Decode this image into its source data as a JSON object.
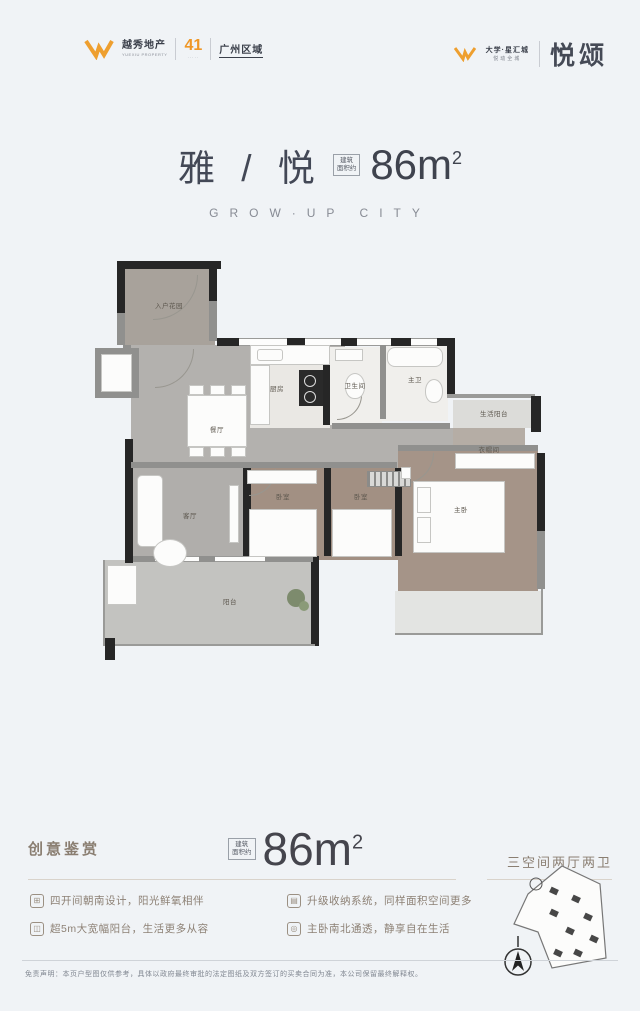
{
  "header": {
    "left_brand": "越秀地产",
    "left_brand_sub": "YUEXIU PROPERTY",
    "left_badge": "41",
    "left_badge_sub": "·····",
    "left_region": "广州区域",
    "right_project": "大学·星汇城",
    "right_project_sub": "悦动全城",
    "right_title": "悦颂"
  },
  "hero": {
    "name": "雅 / 悦",
    "area_prefix_l1": "建筑",
    "area_prefix_l2": "面积约",
    "area_value": "86m",
    "area_sup": "2",
    "subtitle": "GROW·UP CITY"
  },
  "plan": {
    "rooms": [
      {
        "label": "入户花园"
      },
      {
        "label": "餐厅"
      },
      {
        "label": "厨房"
      },
      {
        "label": "卫生间"
      },
      {
        "label": "主卫"
      },
      {
        "label": "生活阳台"
      },
      {
        "label": "衣帽间"
      },
      {
        "label": "客厅"
      },
      {
        "label": "卧室"
      },
      {
        "label": "卧室"
      },
      {
        "label": "主卧"
      },
      {
        "label": "阳台"
      }
    ]
  },
  "bottom": {
    "section_title": "创意鉴赏",
    "area_prefix_l1": "建筑",
    "area_prefix_l2": "面积约",
    "area_value": "86m",
    "area_sup": "2",
    "spec": "三空间两厅两卫",
    "bullets": [
      {
        "icon": "window-icon",
        "glyph": "⊞",
        "text": "四开间朝南设计，阳光鲜氧相伴"
      },
      {
        "icon": "balcony-icon",
        "glyph": "◫",
        "text": "超5m大宽幅阳台，生活更多从容"
      },
      {
        "icon": "storage-icon",
        "glyph": "▤",
        "text": "升级收纳系统，同样面积空间更多"
      },
      {
        "icon": "airflow-icon",
        "glyph": "◎",
        "text": "主卧南北通透，静享自在生活"
      }
    ],
    "disclaimer": "免责声明：本页户型图仅供参考，具体以政府最终审批的法定图纸及双方签订的买卖合同为准，本公司保留最终解释权。"
  }
}
